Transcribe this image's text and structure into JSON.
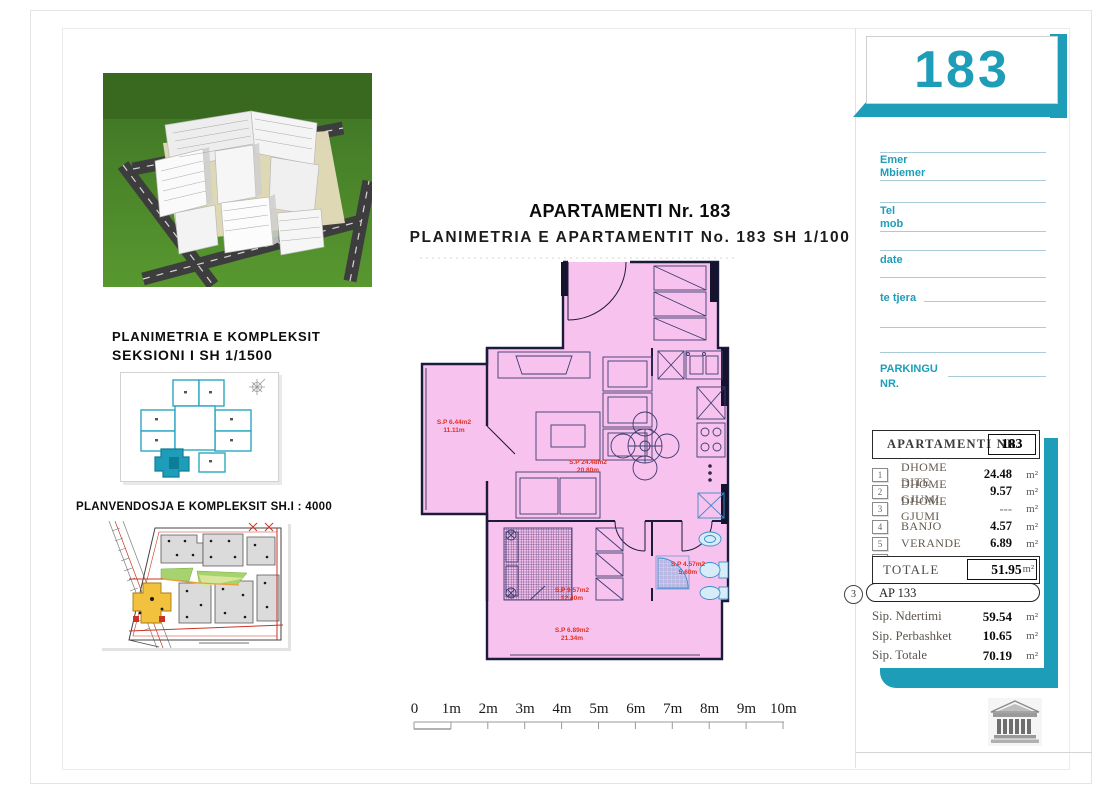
{
  "page": {
    "title": "APARTAMENTI Nr. 183",
    "subtitle": "PLANIMETRIA E APARTAMENTIT No. 183 SH 1/100"
  },
  "left_panels": {
    "complex_caption_line1": "PLANIMETRIA E KOMPLEKSIT",
    "complex_caption_line2": "SEKSIONI I   SH 1/1500",
    "siteplan_caption": "PLANVENDOSJA E KOMPLEKSIT SH.I : 4000"
  },
  "plan": {
    "rooms": [
      {
        "name": "ballkon",
        "area": "S.P 6.44m2",
        "perimeter": "11.11m"
      },
      {
        "name": "dhome dite",
        "area": "S.P 24.48m2",
        "perimeter": "20.80m"
      },
      {
        "name": "dhome gjumi",
        "area": "S.P 9.57m2",
        "perimeter": "12.40m"
      },
      {
        "name": "banjo",
        "area": "S.P 4.57m2",
        "perimeter": "5.60m"
      },
      {
        "name": "verande",
        "area": "S.P 6.89m2",
        "perimeter": "21.34m"
      }
    ]
  },
  "scalebar": {
    "labels": [
      "0",
      "1m",
      "2m",
      "3m",
      "4m",
      "5m",
      "6m",
      "7m",
      "8m",
      "9m",
      "10m"
    ]
  },
  "sidebar": {
    "apartment_number": "183",
    "form": {
      "labels": [
        "Emer",
        "Mbiemer",
        "Tel",
        "mob",
        "date",
        "te tjera",
        "PARKINGU",
        "NR."
      ]
    },
    "table": {
      "header": "APARTAMENTI  NR.",
      "header_number": "183",
      "unit": "m²",
      "rows": [
        {
          "num": "1",
          "label": "DHOME DITE",
          "value": "24.48"
        },
        {
          "num": "2",
          "label": "DHOME GJUMI",
          "value": "9.57"
        },
        {
          "num": "3",
          "label": "DHOME GJUMI",
          "value": "---"
        },
        {
          "num": "4",
          "label": "BANJO",
          "value": "4.57"
        },
        {
          "num": "5",
          "label": "VERANDE",
          "value": "6.89"
        },
        {
          "num": "6",
          "label": "BALLKON",
          "value": "6.44"
        }
      ],
      "totale_label": "TOTALE",
      "totale_value": "51.95",
      "ap_circle": "3",
      "ap_badge": "AP 133",
      "summary": [
        {
          "label": "Sip. Ndertimi",
          "value": "59.54"
        },
        {
          "label": "Sip. Perbashket",
          "value": "10.65"
        },
        {
          "label": "Sip. Totale",
          "value": "70.19"
        }
      ]
    }
  },
  "colors": {
    "teal": "#1e9db8",
    "plan_pink": "#f8c2ef",
    "label_red": "#e03122",
    "wall_dark": "#1b1b3a"
  }
}
